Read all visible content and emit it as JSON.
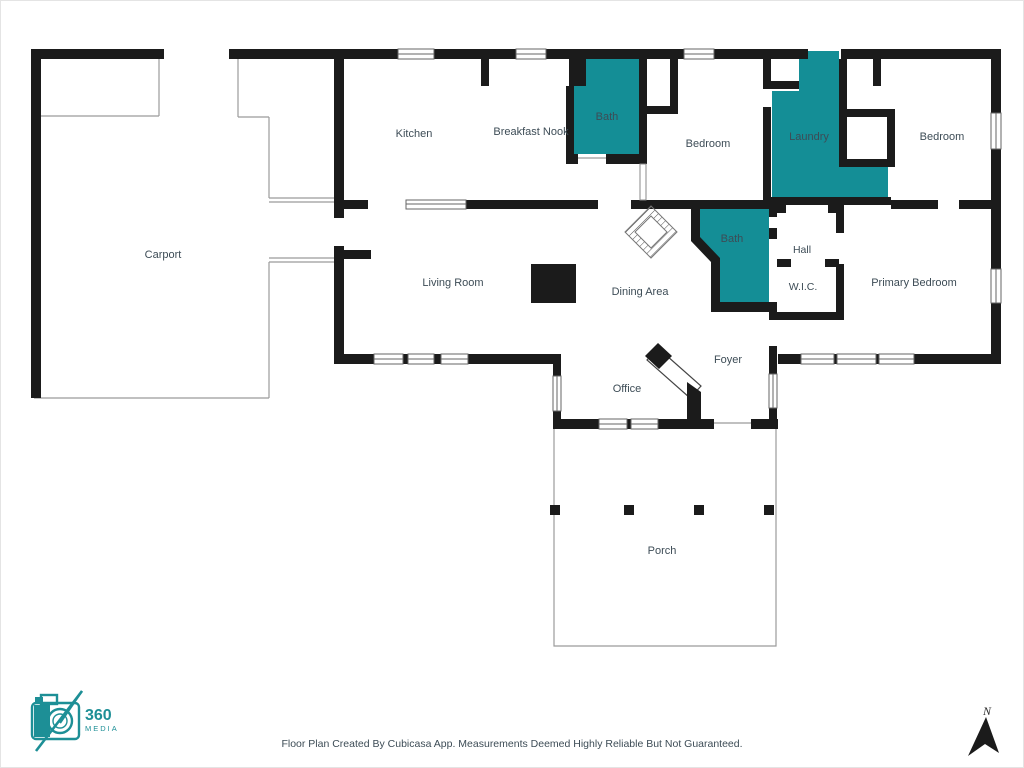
{
  "floor_plan": {
    "rooms": [
      {
        "id": "carport",
        "label": "Carport"
      },
      {
        "id": "kitchen",
        "label": "Kitchen"
      },
      {
        "id": "breakfast-nook",
        "label": "Breakfast Nook"
      },
      {
        "id": "bath-1",
        "label": "Bath"
      },
      {
        "id": "bedroom-1",
        "label": "Bedroom"
      },
      {
        "id": "laundry",
        "label": "Laundry"
      },
      {
        "id": "bedroom-2",
        "label": "Bedroom"
      },
      {
        "id": "living-room",
        "label": "Living Room"
      },
      {
        "id": "dining-area",
        "label": "Dining Area"
      },
      {
        "id": "bath-2",
        "label": "Bath"
      },
      {
        "id": "hall",
        "label": "Hall"
      },
      {
        "id": "wic",
        "label": "W.I.C."
      },
      {
        "id": "primary-bedroom",
        "label": "Primary Bedroom"
      },
      {
        "id": "foyer",
        "label": "Foyer"
      },
      {
        "id": "office",
        "label": "Office"
      },
      {
        "id": "porch",
        "label": "Porch"
      }
    ],
    "colors": {
      "wall": "#1b1b1b",
      "wet_room": "#148e96",
      "label": "#3d4c56",
      "thin_line": "#9b9b9b",
      "logo": "#1d8f96"
    }
  },
  "branding": {
    "logo_number": "360",
    "logo_name": "MEDIA"
  },
  "compass": {
    "north_label": "N"
  },
  "footer": {
    "disclaimer": "Floor Plan Created By Cubicasa App. Measurements Deemed Highly Reliable But Not Guaranteed."
  }
}
